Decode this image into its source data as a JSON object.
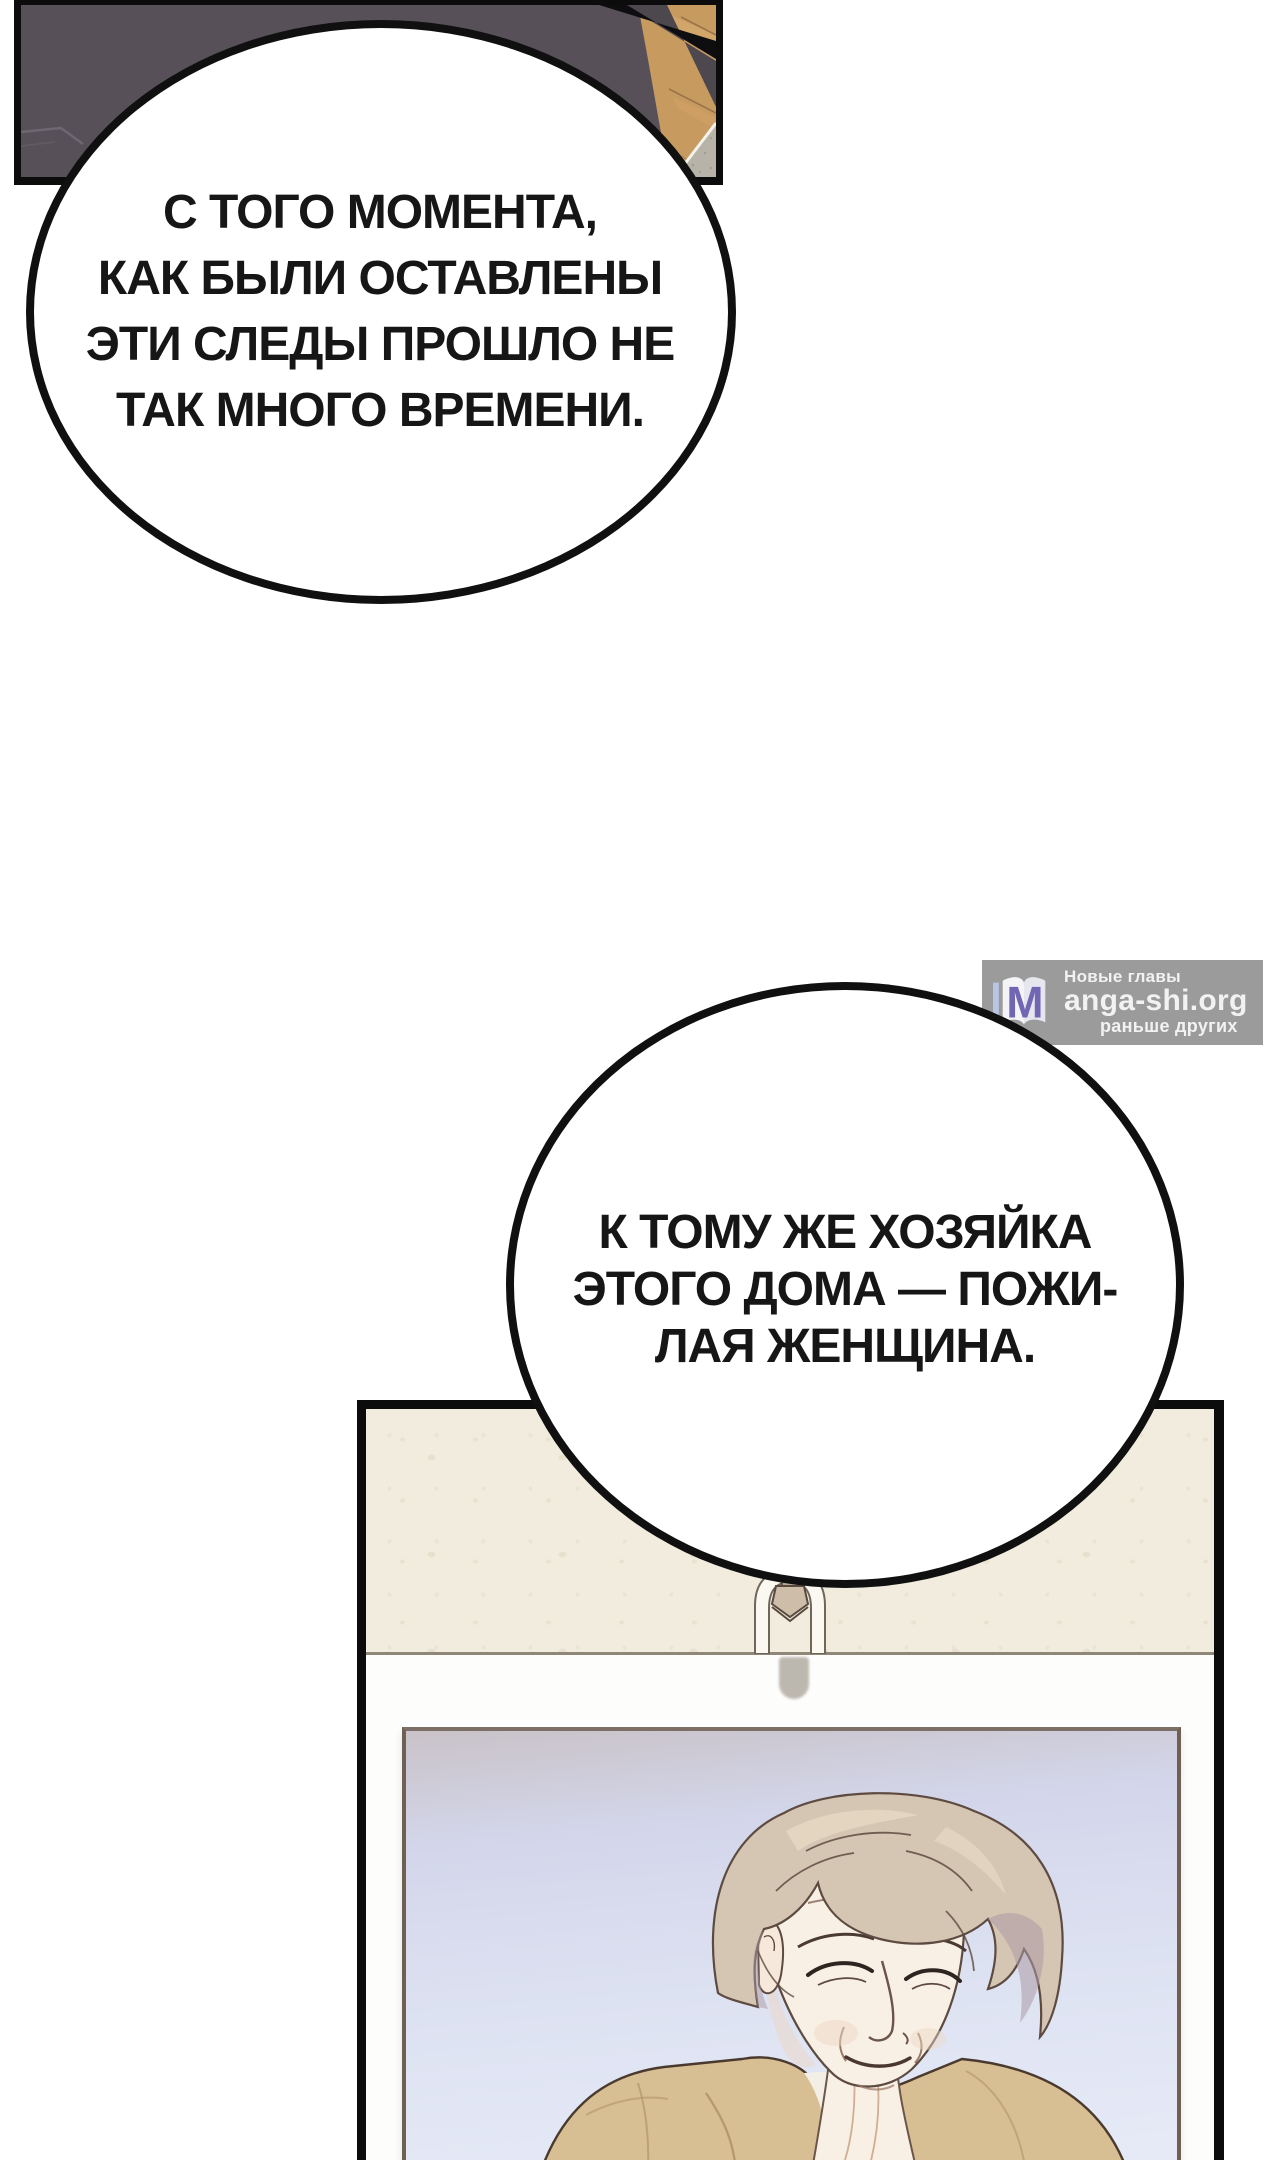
{
  "bubbles": {
    "first": {
      "lines": [
        "С ТОГО МОМЕНТА,",
        "КАК БЫЛИ ОСТАВЛЕНЫ",
        "ЭТИ СЛЕДЫ ПРОШЛО НЕ",
        "ТАК МНОГО ВРЕМЕНИ."
      ]
    },
    "second": {
      "lines": [
        "К ТОМУ ЖЕ ХОЗЯЙКА",
        "ЭТОГО ДОМА — ПОЖИ-",
        "ЛАЯ ЖЕНЩИНА."
      ]
    }
  },
  "watermark": {
    "logo_letter": "M",
    "site_suffix": "anga-shi.org",
    "tagline_top": "Новые главы",
    "tagline_bottom": "раньше других",
    "box_color": "#828282",
    "letter_color": "#7166b4"
  },
  "scene": {
    "colors": {
      "sofa_dark_gray": "#575059",
      "wood_floor": "#c79a5f",
      "corner_mat": "#b8b3a9",
      "wall_cream": "#f1ecde",
      "photo_bg_top": "#c9c2c8",
      "photo_bg_bottom": "#e8ecf8",
      "hair": "#d5c5b3",
      "skin": "#f9f0e5",
      "clothing_tan": "#d8be93",
      "outline_black": "#0c0c0c"
    }
  }
}
